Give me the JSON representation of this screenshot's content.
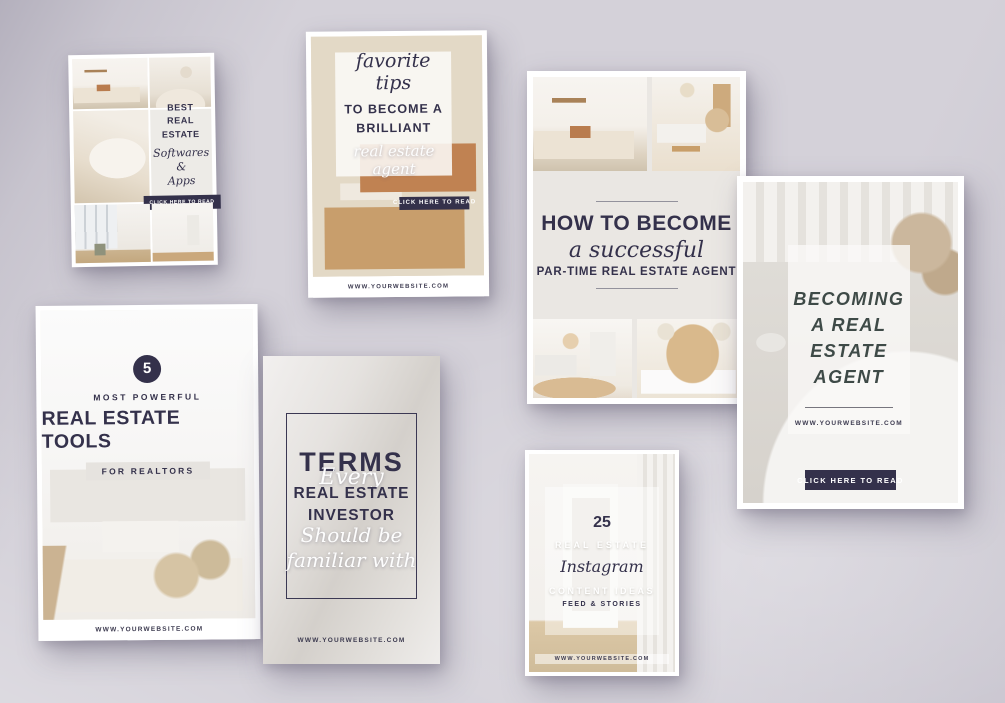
{
  "colors": {
    "navy": "#34314b",
    "slate_title": "#3e4a47",
    "scene_background": "#d4d1d9",
    "card_background": "#ffffff"
  },
  "cards": {
    "softwares": {
      "title_line1": "BEST",
      "title_line2": "REAL ESTATE",
      "script_line1": "Softwares &",
      "script_line2": "Apps",
      "button_label": "CLICK HERE TO READ"
    },
    "tips": {
      "script_heading": "favorite tips",
      "caps_line1": "TO BECOME A",
      "caps_line2": "BRILLIANT",
      "script_subheading": "real estate agent",
      "button_label": "CLICK HERE TO READ",
      "website": "WWW.YOURWEBSITE.COM"
    },
    "how_to_become": {
      "caps_heading": "HOW TO BECOME",
      "script_heading": "a successful",
      "caps_subheading": "PAR-TIME REAL ESTATE AGENT"
    },
    "becoming_agent": {
      "title_line1": "BECOMING A REAL",
      "title_line2": "ESTATE AGENT",
      "website": "WWW.YOURWEBSITE.COM",
      "button_label": "CLICK HERE TO READ"
    },
    "tools": {
      "number": "5",
      "kicker": "MOST POWERFUL",
      "title": "REAL ESTATE TOOLS",
      "tag": "FOR REALTORS",
      "website": "WWW.YOURWEBSITE.COM"
    },
    "terms": {
      "caps_line1": "TERMS",
      "script_line1": "Every",
      "caps_line2": "REAL ESTATE",
      "caps_line3": "INVESTOR",
      "script_line2": "Should be",
      "script_line3": "familiar with",
      "website": "WWW.YOURWEBSITE.COM"
    },
    "instagram": {
      "number": "25",
      "caps_line1": "REAL ESTATE",
      "script_heading": "Instagram",
      "caps_line2": "CONTENT IDEAS",
      "caps_line3": "FEED & STORIES",
      "website": "WWW.YOURWEBSITE.COM"
    }
  }
}
